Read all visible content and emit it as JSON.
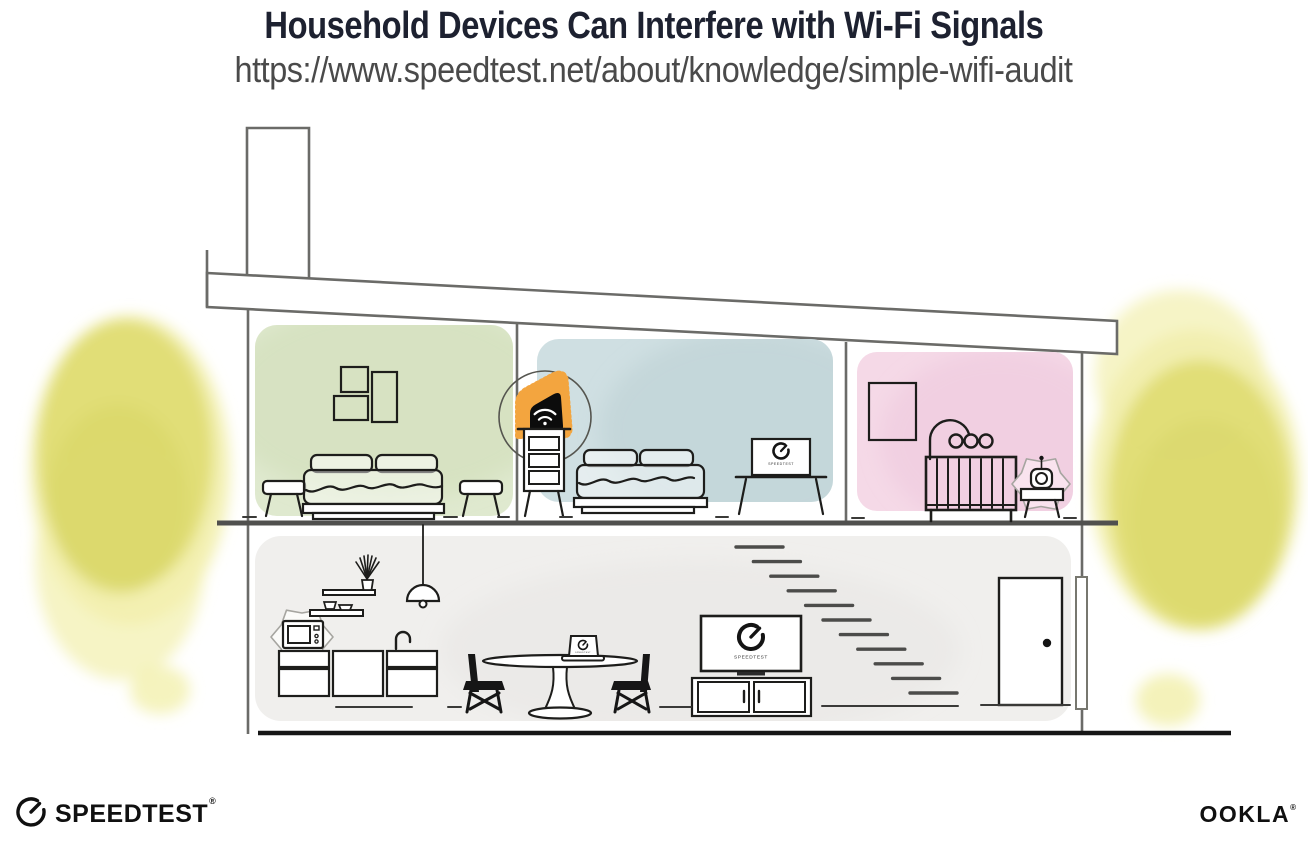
{
  "header": {
    "title": "Household Devices Can Interfere with Wi-Fi Signals",
    "url": "https://www.speedtest.net/about/knowledge/simple-wifi-audit"
  },
  "illustration": {
    "screen_label": "SPEEDTEST",
    "icons": {
      "router": "wifi-icon",
      "tv_and_laptop_screens": "speedtest-gauge-icon",
      "interference": "starburst-icon"
    }
  },
  "branding": {
    "speedtest": "SPEEDTEST",
    "speedtest_reg": "®",
    "ookla": "OOKLA",
    "ookla_reg": "®"
  },
  "colors": {
    "title": "#1d2130",
    "url": "#4a4a4a",
    "wall_line": "#6b6b68",
    "furniture_line": "#1d1d1b",
    "room_green": "#dfe9cf",
    "room_green_shade": "#cfdcb6",
    "room_blue": "#cfdfe2",
    "room_blue_shade": "#bcd0d4",
    "room_pink": "#f5d9e7",
    "room_pink_shade": "#eec6dc",
    "room_gray": "#f0efed",
    "room_gray_shade": "#e7e6e3",
    "accent_orange": "#f3a53f",
    "bush_yellow": "#e0dd74",
    "bush_yellow_light": "#f2f0ae",
    "bush_yellow_dark": "#d5d160",
    "black": "#111111"
  }
}
